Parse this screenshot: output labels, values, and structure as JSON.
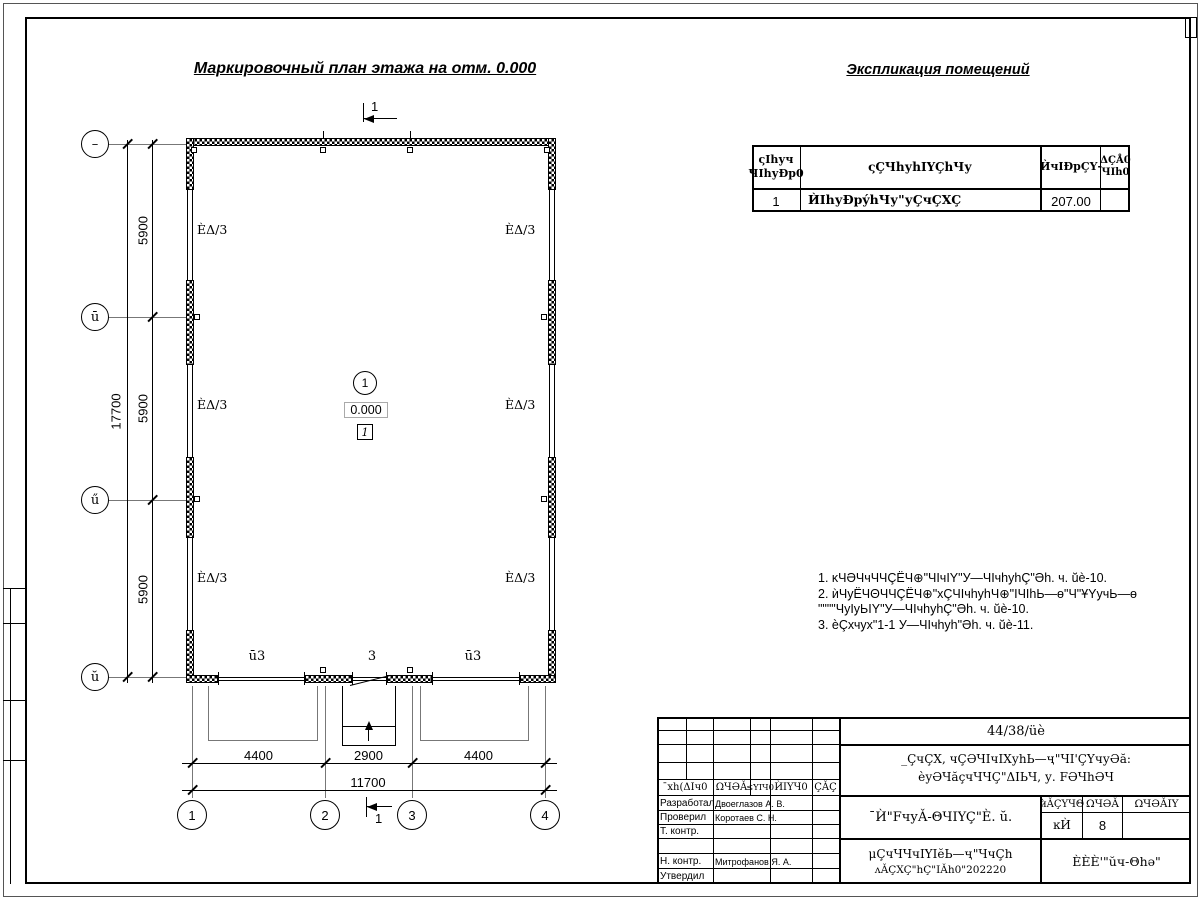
{
  "titles": {
    "plan": "Маркировочный план этажа на отм. 0.000",
    "explication": "Экспликация помещений"
  },
  "plan": {
    "wall_mark": "ÈΔ/3",
    "section_mark": "1",
    "room": {
      "number": "1",
      "elevation": "0.000",
      "floor_mark": "1"
    },
    "openings": {
      "left": "ū3",
      "middle": "3",
      "right": "ū3"
    }
  },
  "grid": {
    "rows": [
      "–",
      "ū",
      "ű",
      "ŭ"
    ],
    "cols": [
      "1",
      "2",
      "3",
      "4"
    ]
  },
  "dimensions": {
    "left": {
      "segments": [
        "5900",
        "5900",
        "5900"
      ],
      "total": "17700"
    },
    "bottom": {
      "segments": [
        "4400",
        "2900",
        "4400"
      ],
      "total": "11700"
    }
  },
  "explication": {
    "headers": {
      "num_line1": "ςIhуч",
      "num_line2": "ЧIhуÐр0",
      "name": "ςÇЧhуhIYÇhЧу",
      "area": "ЍчIÐрÇҮ-",
      "note_line1": "ΔÇÅ0",
      "note_line2": "ЧIh0"
    },
    "row": {
      "num": "1",
      "name": "ЍIhуÐрýhЧу\"уÇчÇXÇ",
      "area": "207.00",
      "note": ""
    }
  },
  "notes": {
    "line1": "1. ĸЧӘЧчЧЧÇЁЧ⊕\"ЧIчIY\"У—ЧIчhуhÇ\"Әh. ч. ŭè-10.",
    "line2": "2. ѝЧуЁЧΘЧЧÇЁЧ⊕\"хÇЧIчhуhЧ⊕\"IЧIhЬ—ө\"Ч\"ҰYучЬ—ө",
    "line3": "\"\"\"\"ЧуIуЬIY\"У—ЧIчhуhÇ\"Әh. ч. ŭè-10.",
    "line4": "3. ѐÇхчух\"1-1 У—ЧIчhуh\"Әh. ч. ŭè-11."
  },
  "title_block": {
    "doc_number": "44/38/üè",
    "project_line1": "_ÇчÇX, чÇӘЧIчIXуhЬ—ҷ\"ЧI'ÇҮчуӘă:",
    "project_line2": "ѐуӘЧăçчЧЧÇ\"ΔIЬЧ, у. FӘЧhӘЧ",
    "columns": {
      "izm": "¯хh(ΔIч0",
      "kol": "ΩЧӘǍ",
      "list": "≤YIЧ0",
      "ndok": "ЍIYЧ0",
      "podp": "ÇǍÇ"
    },
    "roles": [
      {
        "label": "Разработал",
        "name": "Двоеглазов А. В."
      },
      {
        "label": "Проверил",
        "name": "Коротаев С. Н."
      },
      {
        "label": "Т. контр.",
        "name": ""
      },
      {
        "label": "",
        "name": ""
      },
      {
        "label": "Н. контр.",
        "name": "Митрофанов Я. А."
      },
      {
        "label": "Утвердил",
        "name": ""
      }
    ],
    "sheet_title": "¯Ѝ\"FчуǍ-ΘЧIYÇ\"Ѐ. ŭ.",
    "stage": {
      "header_stage": "ѝǍÇYЧΘ",
      "header_sheet": "ΩЧӘǍ",
      "header_sheets": "ΩЧӘǍIY",
      "stage_value": "ĸЍ",
      "sheet_value": "8",
      "sheets_value": ""
    },
    "org_line1": "μÇчЧЧчIYIĕЬ—ҷ\"ЧчÇh",
    "org_line2": "ʌǍÇXÇ\"hÇ\"IǍh0\"202220",
    "company": "ÈÈÈ'\"ŭч-Θhә\""
  }
}
